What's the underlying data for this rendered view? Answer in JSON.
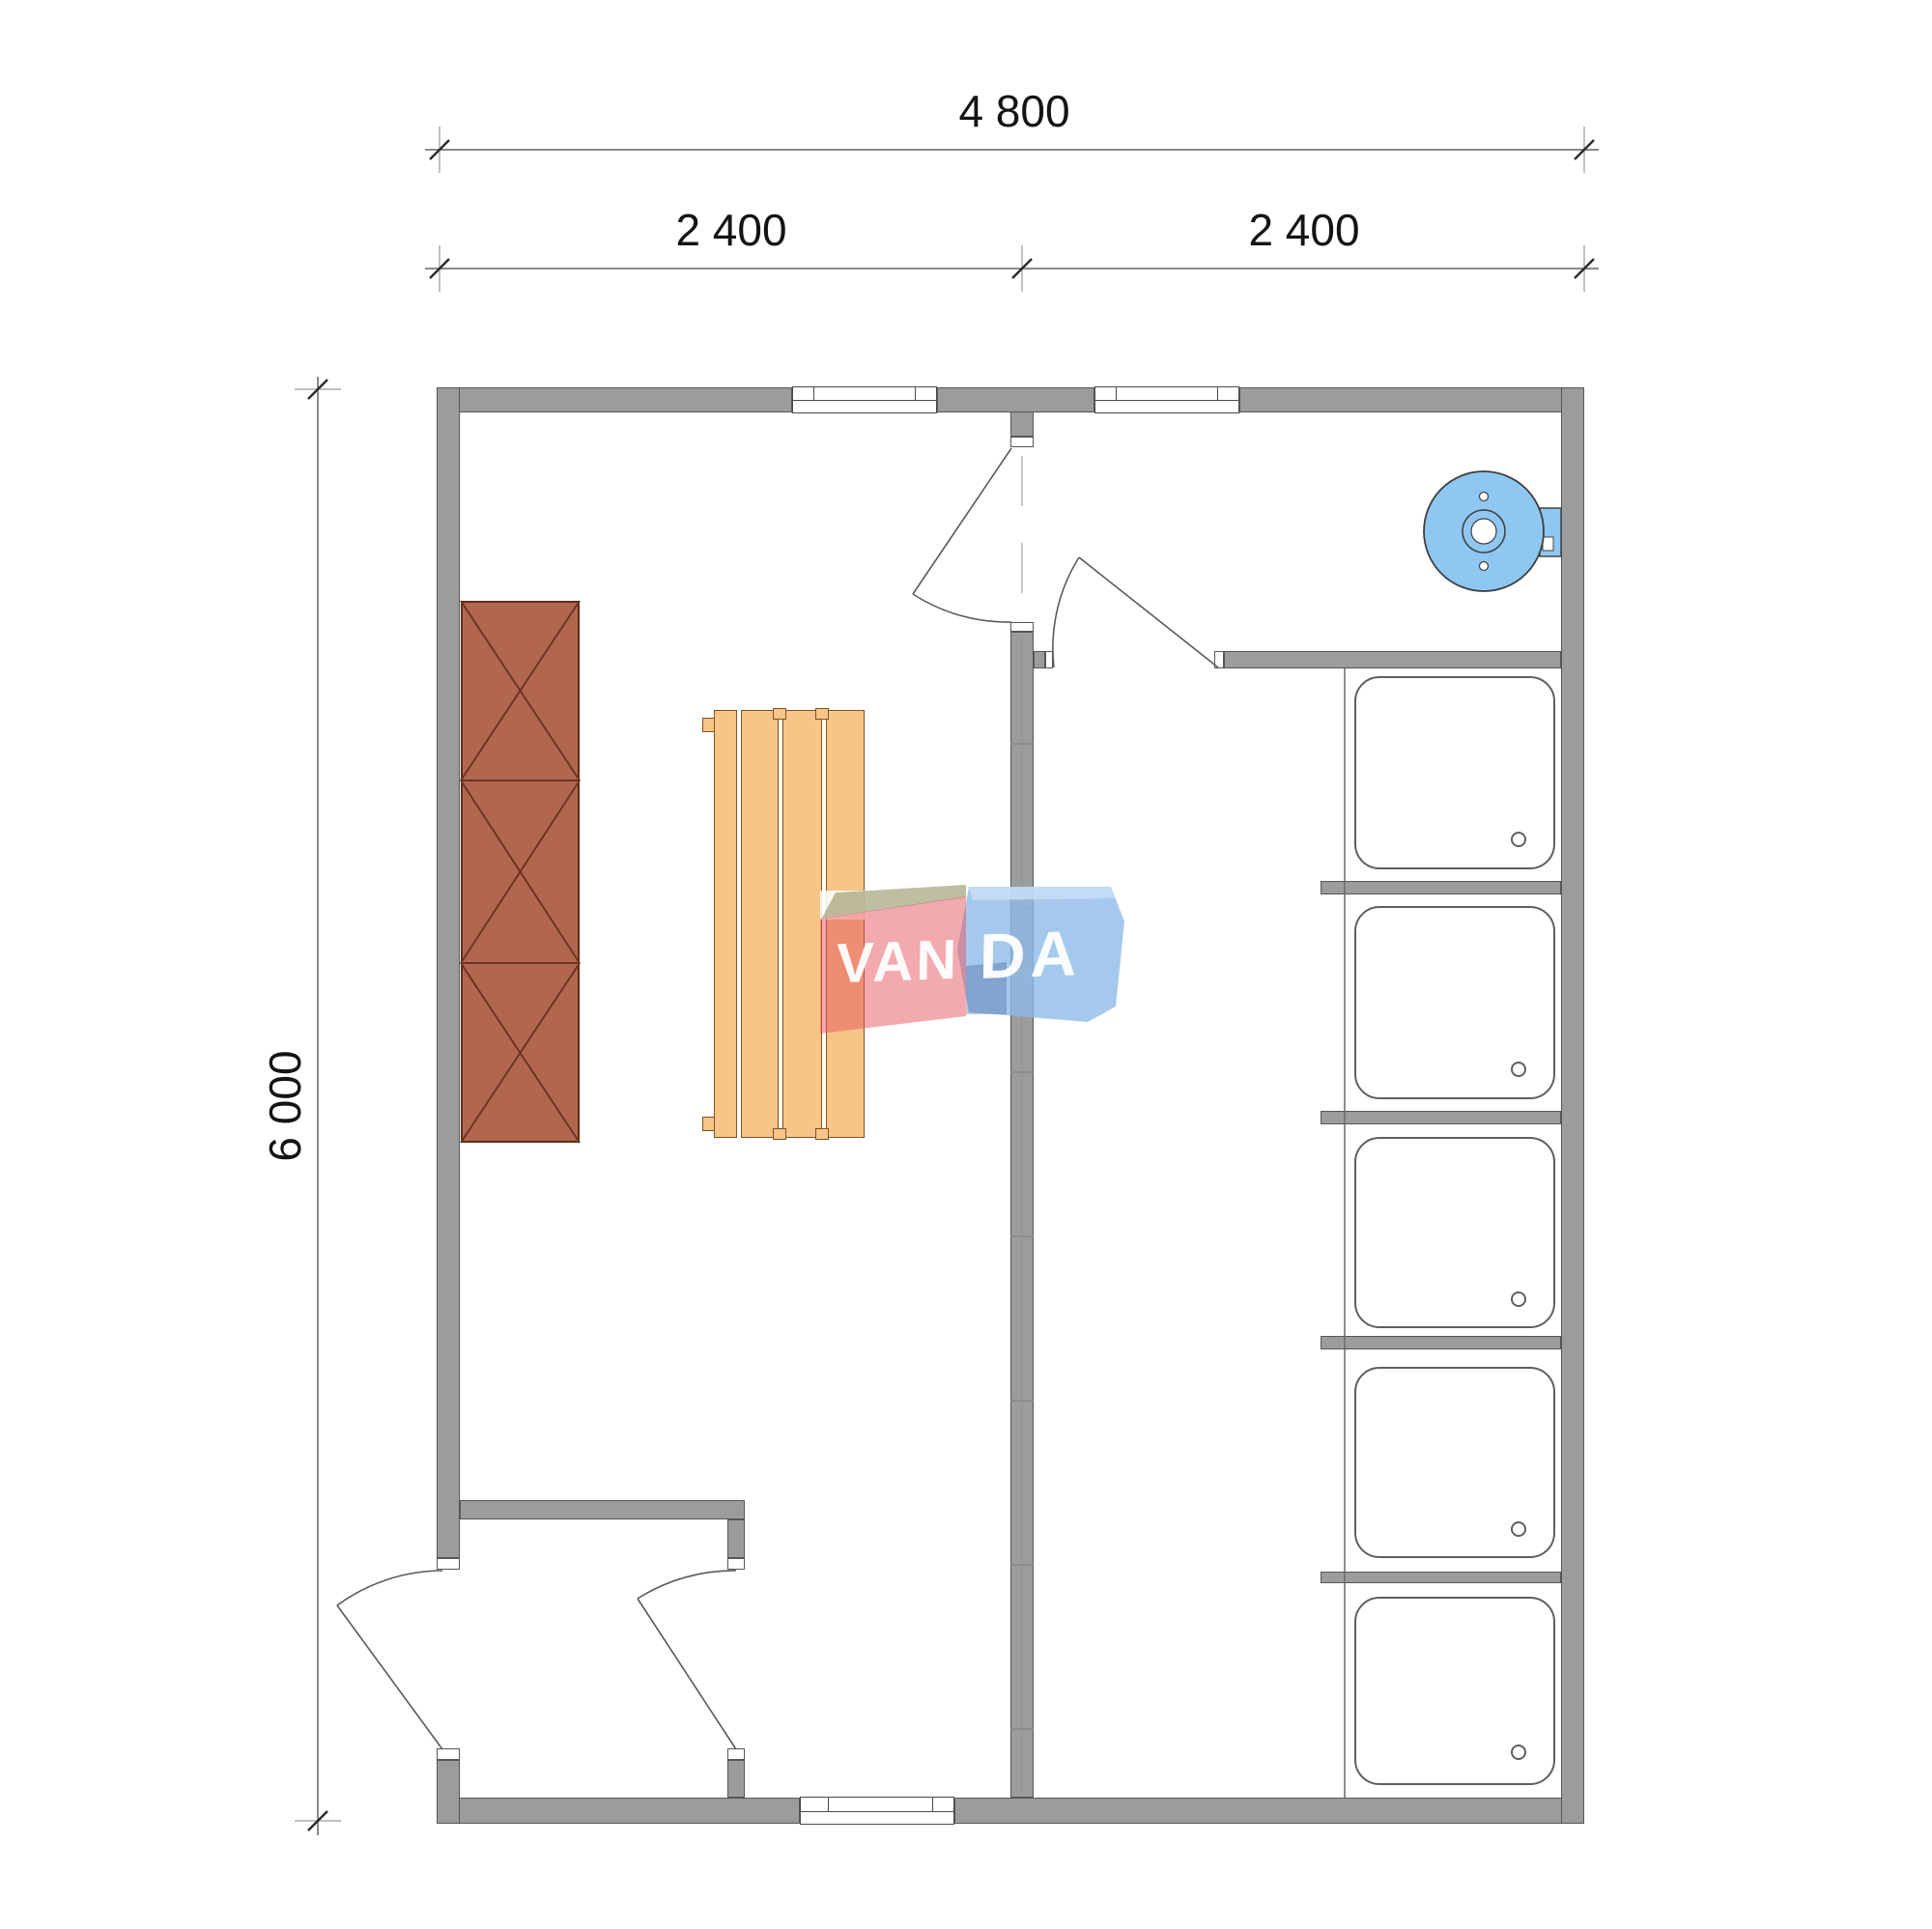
{
  "plan": {
    "dimensions": {
      "width_total_label": "4 800",
      "width_left_label": "2 400",
      "width_right_label": "2 400",
      "height_total_label": "6 000"
    },
    "watermark": {
      "left": "VAN",
      "right": "DA",
      "full": "VANDA"
    },
    "fixtures": {
      "shower_stall_count": 5,
      "shower_drain_count": 5,
      "bench_slat_count": 4,
      "cabinet_section_count": 3,
      "door_count": 4,
      "window_count": 3
    },
    "colors": {
      "wall_gray": "#9c9c9c",
      "heater_blue": "#8ec7f1",
      "bench_wood": "#f6c587",
      "cabinet_wood": "#b1674e",
      "watermark_red": "#e7555f",
      "watermark_blue": "#8ebce8"
    }
  }
}
